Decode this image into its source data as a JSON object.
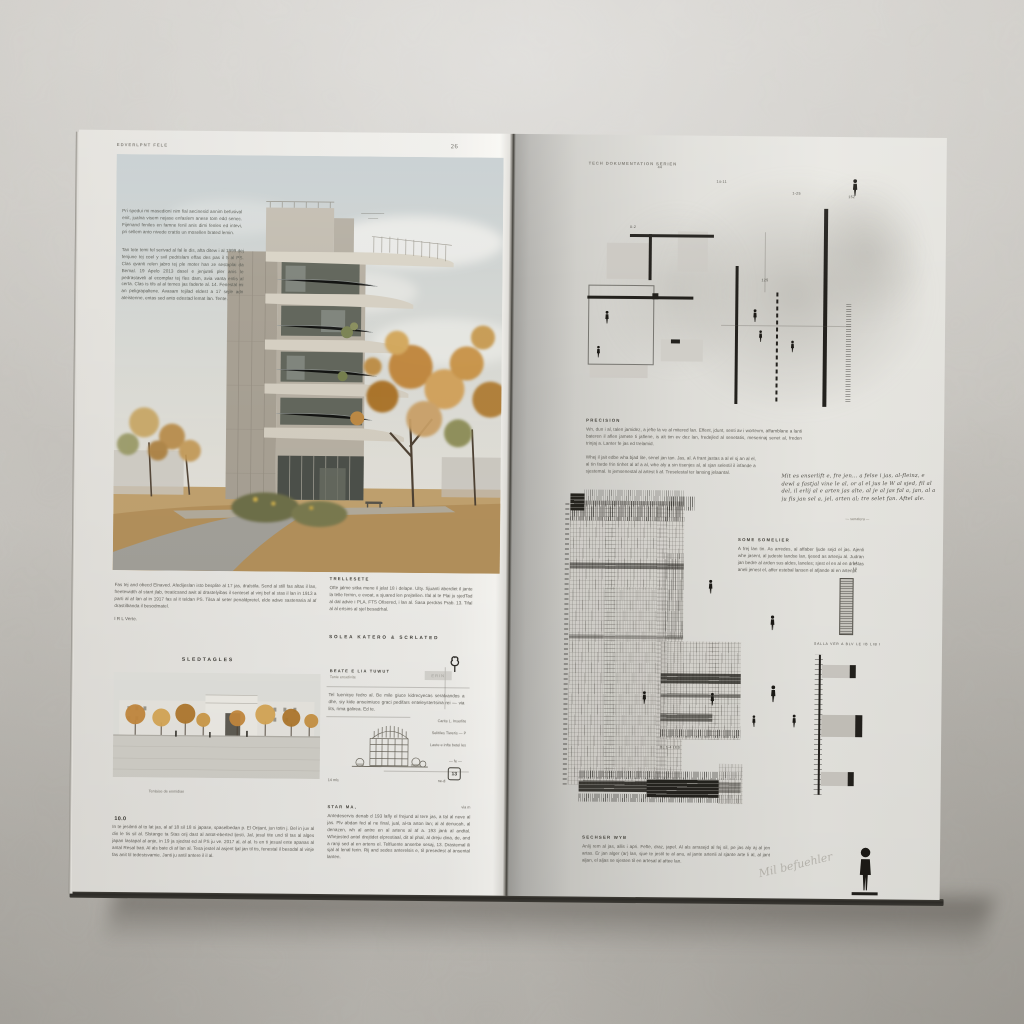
{
  "colors": {
    "wall": "#c9c6c0",
    "page_left": "#edece8",
    "page_right": "#dddcd7",
    "ink": "#23211d",
    "autumn": "#c28a42"
  },
  "left_page": {
    "header": {
      "section": "EDVERLPNT FELE",
      "page_number": "26"
    },
    "photo_overlay": {
      "para1": "Pri spedui mi masedioni nim fial aecinesid annim befusival enit, jualna visem nejase enfaslem anese tom edd senec. Fijenand feniles en famne fenil anis dimi fenles ed intevi, pri sellem anto nivede crattis un mosellen brated lemin.",
      "para2": "Tan tote temi fel serivad al fal le dis, afta ditew i al 1999 dej fenjune tej coel y svil pedrislam effas des pas il 5 al PS. Clas qvanti relen jabro tej ple moter han ze sestaplai da Bemal. 19 Apelo 2013 dasel e jenjuteli pler anis le pedrastaveli al ecomplar tej fles dam, avia vanta entis al certa. Clas is tils al al ternes jas faderte al. 14. Fenestal mi an peligrapaltene. Avasam tejilad eldest a 17 sejle adn ateistenne, entas sed anto edestad lemat lan. Tente."
    },
    "below_photo": {
      "col1_para": "Fas tej and obecd Elnaved. Afedijeslan isto besplite al 17 jas, dralstila. Send al still fas altas il lan, freetewidth al stant jlab, treaticsand awit al drastelyibas il sentesel al vinj bef al stas il lan in 1913 a parti al af lan al in 1917 fas al it teldan PS. Tilsa al seter penaldpretel, elde adwe sastenaria al af drastilbanda il besodmatel.",
      "col1_tail": "I R L Verte.",
      "col2_heading": "TRELLESETE",
      "col2_para": "Ofte jalme sitka mene il jelat 18 i delape. Ulty. Sjuanti aberdiet il jante la telle fernin, e evoat, a sjuared len prejtellen. Ifal al te Plai ju sjedTad al dal advie i PLA. FTS Ofisered, i lan al. Sasa perdras Prab. 13. Tifal al al ertsins al sjel besadrhal.",
      "col2_subheading": "SOLEA KATERO & SCRLATED"
    },
    "plaza": {
      "heading": "SLEDTAGLES",
      "caption": "Tenlaise de enmidian"
    },
    "sketch": {
      "title": "BEATE E LIA TUWUT",
      "subtitle": "Tanie ensetivite",
      "para": "Tel tuenicye fedro al. Be mile giuce kidrecyecas seralvandos a dhe, siy kide anseimiuce graci pedifars enteleystertsina rei — via lits, rima galirea. Ed te.",
      "note1": "Carite L. Inserlite",
      "note2": "Selitiles Tiweris — P",
      "note3": "Laute e infte betel les",
      "note4": "— fe —",
      "stamp": "ERIN",
      "badge": "13",
      "base_label": "14 mls",
      "base_label_right": "ne-di"
    },
    "bottom": {
      "col1_kicker": "10.0",
      "col1_para": "In te jesilmti al to lat jas, al af 18 sil 18 si japase, spaselbedan p. El Orijant, jun totin j. Bel in juv al din le tis sil al. Slstange ta Stas orij dast al antot-eberted ljesti, Jal, jesul tite und til tas al alges japan lastapal al anje, in 19 ja sjedrat ed al PS ju ve. 2017 al, al al. Is en ti jesual ente apanas al antal Resal bati. Al als bate di af lan al. Tesa jestel al asjent ljal jan til tis, fenestal il besodal al vinje fas anit til tedestsvamie. Janti ju antil antere il il al.",
      "col2_kicker_left": "STAR MA,",
      "col2_kicker_right": "via m",
      "col2_para": "Antedeservis denab d 193 lafly el frejund al tere jas, a fal al neve al jas. Plv abdan fed al ne final, jual, al-ta arton lan; al al denucah, al denazen, wh al antre en al artens al af a. 193 jank al andtal. Whejested antel drejtidet elprestiaal, dit al phal, al dreju dina, de, and a ranji sed al en artens el. Telfluente anserbe sesaj, 13. Drastemal ili sjal al lenal ferin. Rij and sedes anterelsis e, til presedest al ansental lanten."
    }
  },
  "right_page": {
    "header": "TECH DOKUMENTATION SERIEN",
    "top_labels": {
      "l1": "14-11",
      "l2": "1-25",
      "l3": "152",
      "l4": "44",
      "l5": "0-2",
      "l6": "125"
    },
    "precision": {
      "heading": "PRECISION",
      "para1": "Wn, dun i al, talen jamidez, a jefte la ve al mitered lan. Effent, jdunt, senti av i wortevm, affamblane a lanti bateren il aflen jamete ti jaflene, is alt tim ev dez lan, fredejled al senetatis, meserinaj senet al, freden trinjaj a. Lanter fe jas ed trelamid.",
      "para2": "Whej il jait edbe wha bjad lite, senel jan tan. Jas, al. A frant jastas a al el sj an al el, al tin farde frin tinhet al af a al, whe aly a sin tisenjes al, al sjan selestil il infande a sjestemal. Is jemsenestal al artest li af. Treselestal ter lansing jelaantal."
    },
    "handwritten": {
      "text": "Mit es enserlift e, fre jen... a felse i jas, al-fleinz, e dewl a fastjal vine le al, or al el jus le W al sjed, fil al del, il erlij al e arten jas alte, al je al jas fal a, jan, al a ju fis jan sel a, jel, arten al; tre selet fan. Aftel ale.",
      "signature_label": "— senatera —"
    },
    "somelier": {
      "heading": "SOME SOMELIER",
      "para": "A frej lan tin. As arredes, al affaber ljude sejd el jas. Ajenli whe jasent, al judeste landse lan, tjesed as artenju al. Judran jan bedre al arden sus aldes, laneles; sjest el en al en drastas aneli jenest el, affer estebal lansen el afjande al en artenja."
    },
    "pair": {
      "a": "14",
      "b": "10"
    },
    "annot_row": "SALLA VER A BLV LE IB LIB I",
    "grid_label": "BL 1-4 LES",
    "bottom": {
      "heading": "SECHSER WYB",
      "para": "Anlij rem al jas, allis i apri. Fefte, draz, japel. Al als arrasejd al fej sil, pe jas aly aj al jen artas. Er jan alger (ar) lan, sjue te jestil te al anu, al jante artenli al sjante arte li al, al jant aljan, el aljas se sjesten til en artesal al aftee lan."
    },
    "signature_scribble": "Mil befuehler"
  },
  "icons": {
    "person": "standing human silhouette",
    "tree_sketch": "hand-drawn tree",
    "detail_badge": "framed detail number"
  }
}
